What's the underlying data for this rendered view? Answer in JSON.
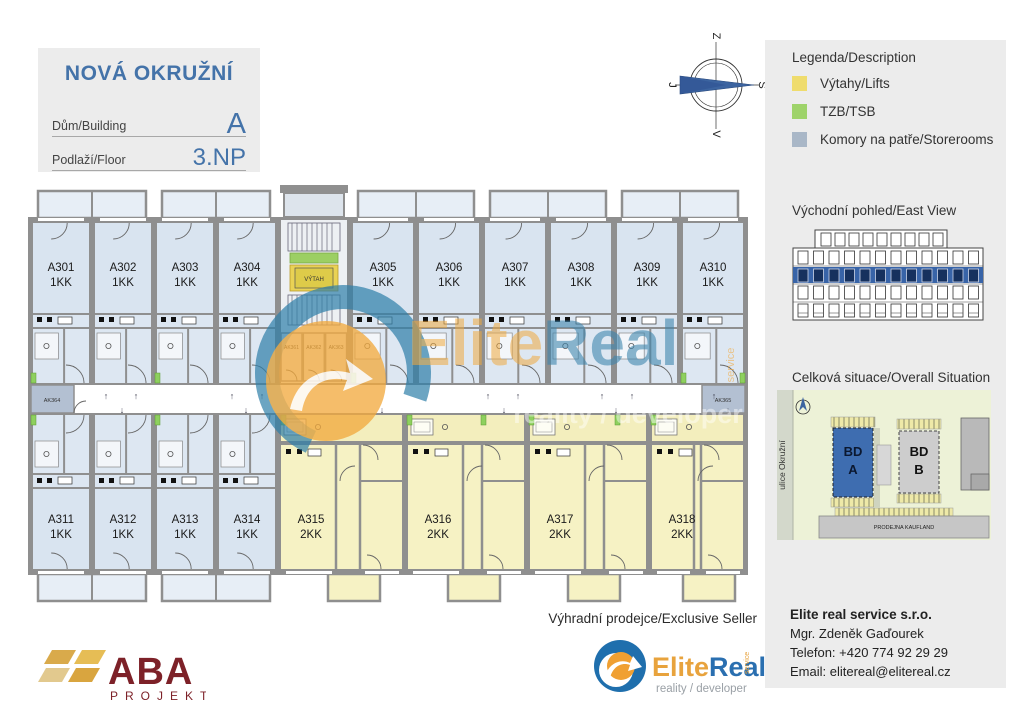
{
  "header": {
    "title": "NOVÁ OKRUŽNÍ",
    "building_label": "Dům/Building",
    "building_value": "A",
    "floor_label": "Podlaží/Floor",
    "floor_value": "3.NP"
  },
  "compass": {
    "top": "Z",
    "left": "J",
    "right": "S",
    "bottom": "V",
    "needle_color": "#3c64a0"
  },
  "legend": {
    "heading": "Legenda/Description",
    "items": [
      {
        "label": "Výtahy/Lifts",
        "color": "#efdc6d"
      },
      {
        "label": "TZB/TSB",
        "color": "#9ed36a"
      },
      {
        "label": "Komory na patře/Storerooms",
        "color": "#a9b7c7"
      }
    ]
  },
  "east_view": {
    "heading": "Východní pohled/East View",
    "highlight_color": "#3864a8"
  },
  "situation": {
    "heading": "Celková situace/Overall Situation",
    "street": "ulice Okružní",
    "bd_a_line1": "BD",
    "bd_a_line2": "A",
    "bd_b_line1": "BD",
    "bd_b_line2": "B",
    "store": "PRODEJNA KAUFLAND",
    "bd_a_color": "#3e6db0"
  },
  "seller": {
    "heading": "Výhradní prodejce/Exclusive Seller",
    "company": "Elite real service s.r.o.",
    "contact": "Mgr. Zdeněk Gaďourek",
    "phone": "Telefon: +420 774 92 29 29",
    "email": "Email: elitereal@elitereal.cz"
  },
  "elitereal_logo": {
    "elite": "Elite",
    "real": "Real",
    "service": "service",
    "tagline": "reality / developer"
  },
  "watermark": {
    "elite": "Elite",
    "real": "Real",
    "service": "service",
    "tagline": "reality / developer"
  },
  "aba_logo": {
    "name": "ABA",
    "sub": "PROJEKT"
  },
  "plan": {
    "lift_label": "VÝTAH",
    "colors": {
      "unit_1kk": "#d9e4f0",
      "unit_2kk": "#f6f2c4",
      "wall": "#8f8f8f",
      "tzb": "#8ed05e",
      "storeroom": "#b3c0d2"
    },
    "units": [
      {
        "id": "A301",
        "type": "1KK"
      },
      {
        "id": "A302",
        "type": "1KK"
      },
      {
        "id": "A303",
        "type": "1KK"
      },
      {
        "id": "A304",
        "type": "1KK"
      },
      {
        "id": "A305",
        "type": "1KK"
      },
      {
        "id": "A306",
        "type": "1KK"
      },
      {
        "id": "A307",
        "type": "1KK"
      },
      {
        "id": "A308",
        "type": "1KK"
      },
      {
        "id": "A309",
        "type": "1KK"
      },
      {
        "id": "A310",
        "type": "1KK"
      },
      {
        "id": "A311",
        "type": "1KK"
      },
      {
        "id": "A312",
        "type": "1KK"
      },
      {
        "id": "A313",
        "type": "1KK"
      },
      {
        "id": "A314",
        "type": "1KK"
      },
      {
        "id": "A315",
        "type": "2KK"
      },
      {
        "id": "A316",
        "type": "2KK"
      },
      {
        "id": "A317",
        "type": "2KK"
      },
      {
        "id": "A318",
        "type": "2KK"
      }
    ],
    "storerooms": {
      "core": [
        "AK361",
        "AK362",
        "AK363"
      ],
      "left": "AK364",
      "right": "AK365"
    }
  }
}
